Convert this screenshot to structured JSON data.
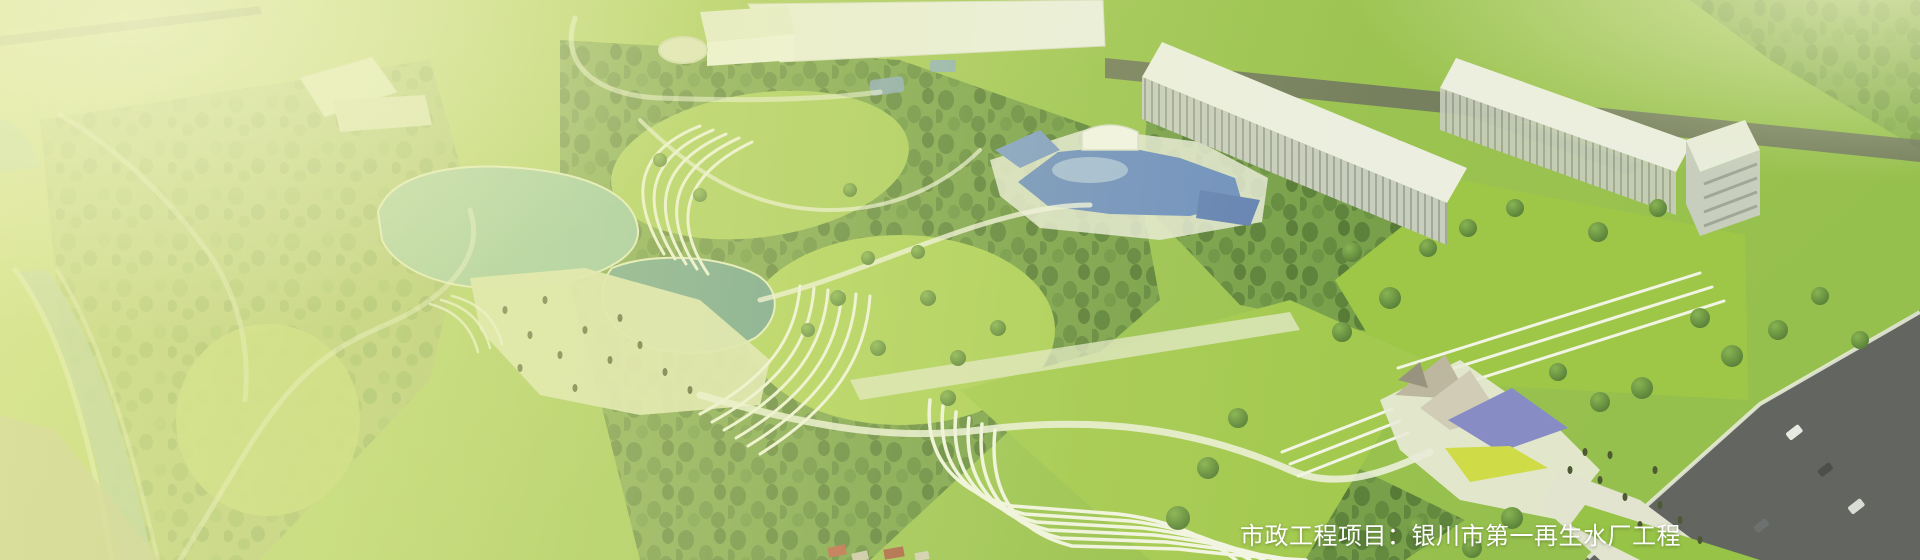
{
  "caption": {
    "text": "市政工程项目：银川市第一再生水厂工程",
    "color": "#ffffff"
  },
  "palette": {
    "lawn": "#95c046",
    "lawn_bright": "#a6cc52",
    "forest_dark": "#4c7530",
    "water_teal": "#8cbfa8",
    "water_pond": "#5c948e",
    "pool_blue": "#6286c6",
    "canal": "#9cbcaa",
    "building_white": "#eef0e9",
    "building_shade": "#c6cbc2",
    "road_dark": "#55565c",
    "road_top": "#63665a",
    "path_light": "#e9eae0",
    "beach_sand": "#dce3ba",
    "canopy_blue": "#7d82cb",
    "canopy_yellow": "#cdda3f",
    "canopy_grey": "#b9b2a2",
    "house_roof_red": "#b6513f",
    "field_beige": "#b7b495",
    "wash_yellow_green": "#e6ec9e"
  }
}
